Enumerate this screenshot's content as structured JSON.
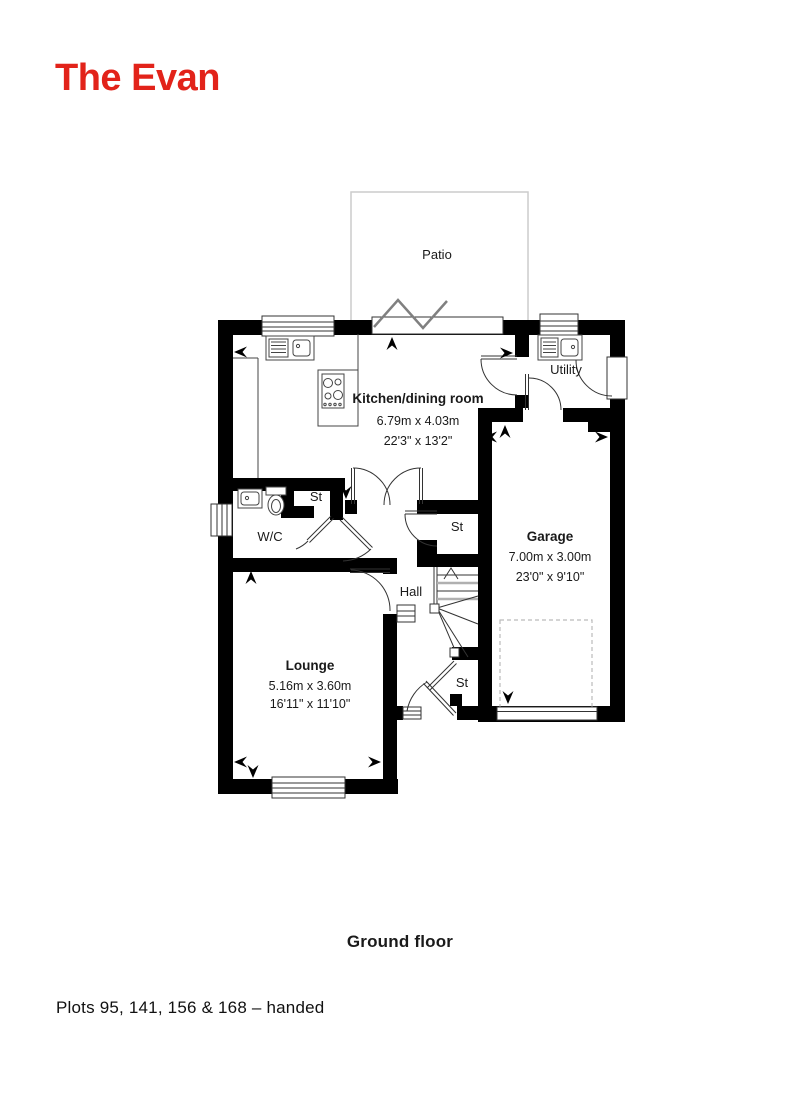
{
  "title": "The Evan",
  "floor_label": "Ground floor",
  "plots_note": "Plots 95, 141, 156 & 168 – handed",
  "colors": {
    "accent_red": "#E2231A",
    "wall": "#000000",
    "patio_outline": "#cccccc",
    "dashed_zone": "#bbbbbb"
  },
  "rooms": {
    "patio": {
      "name": "Patio"
    },
    "kitchen": {
      "name": "Kitchen/dining room",
      "size_metric": "6.79m x 4.03m",
      "size_imperial": "22'3\" x 13'2\""
    },
    "utility": {
      "name": "Utility"
    },
    "garage": {
      "name": "Garage",
      "size_metric": "7.00m x 3.00m",
      "size_imperial": "23'0\" x 9'10\""
    },
    "wc": {
      "name": "W/C"
    },
    "hall": {
      "name": "Hall"
    },
    "lounge": {
      "name": "Lounge",
      "size_metric": "5.16m x 3.60m",
      "size_imperial": "16'11\" x 11'10\""
    },
    "store1": {
      "name": "St"
    },
    "store2": {
      "name": "St"
    },
    "store3": {
      "name": "St"
    }
  }
}
